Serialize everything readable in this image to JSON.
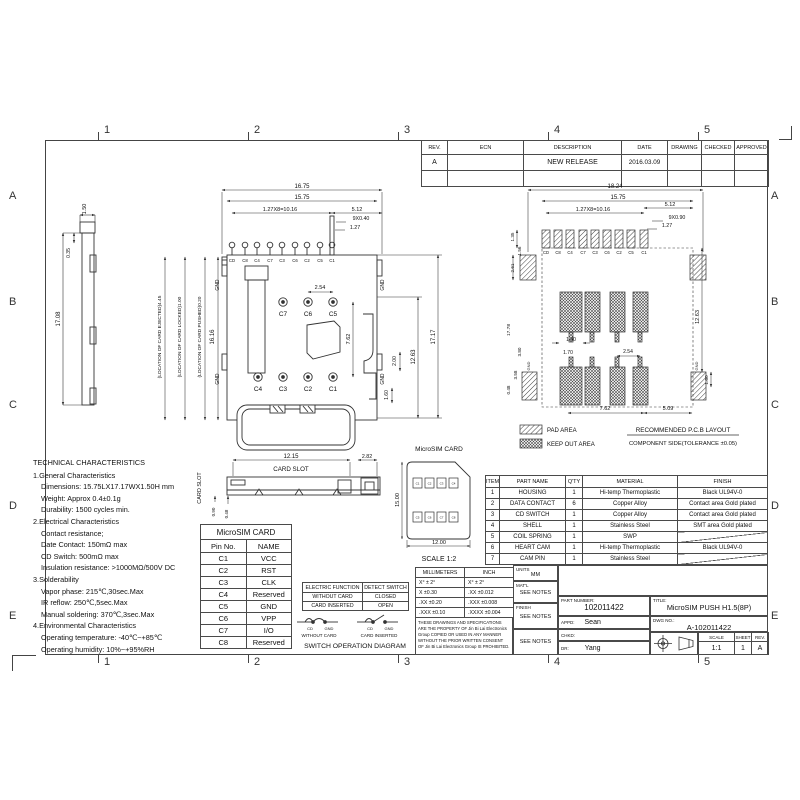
{
  "frame": {
    "cols": [
      "1",
      "2",
      "3",
      "4",
      "5"
    ],
    "rows": [
      "A",
      "B",
      "C",
      "D",
      "E"
    ]
  },
  "rev": {
    "headers": [
      "REV.",
      "ECN",
      "DESCRIPTION",
      "DATE",
      "DRAWING",
      "CHECKED",
      "APPROVED"
    ],
    "row": {
      "rev": "A",
      "ecn": "",
      "description": "NEW RELEASE",
      "date": "2016.03.09",
      "drawing": "",
      "checked": "",
      "approved": ""
    }
  },
  "side": {
    "d_w": "1.50",
    "d_step": "0.35",
    "d_h": "17.08"
  },
  "top": {
    "d1": "16.75",
    "d2": "15.75",
    "d3": "1.27X8=10.16",
    "d4": "5.12",
    "d5": "9X0.40",
    "d6": "1.27",
    "pins": [
      "CD",
      "C8",
      "C4",
      "C7",
      "C3",
      "C6",
      "C2",
      "C5",
      "C1"
    ],
    "gnd": "GND",
    "uc": [
      "C7",
      "C6",
      "C5"
    ],
    "lc": [
      "C4",
      "C3",
      "C2",
      "C1"
    ],
    "d7": "2.54",
    "d8": "7.62",
    "d9": "12.63",
    "d10": "17.17",
    "d11": "16.16",
    "d12": "2.00",
    "d13": "1.60",
    "loc": [
      "(LOCATION OF CARD EJECTED)4.45",
      "(LOCATION OF CARD LOCKED)1.00",
      "(LOCATION OF CARD PUSHED)0.20"
    ]
  },
  "pcb": {
    "d1": "18.24",
    "d2": "15.75",
    "d3": "1.27X8=10.16",
    "d4": "5.12",
    "d5": "9X0.90",
    "d6": "1.27",
    "pins": [
      "CD",
      "C8",
      "C4",
      "C7",
      "C3",
      "C6",
      "C2",
      "C5",
      "C1"
    ],
    "d135": "1.35",
    "d156": "1.56",
    "d261": "2.61",
    "d1778": "17.78",
    "d380": "3.80",
    "d358": "3.58",
    "d048": "0.48",
    "d140": "1.40",
    "d170": "1.70",
    "d254": "2.54",
    "d762": "7.62",
    "d509": "5.09",
    "d1263": "12.63",
    "d160": "1.60",
    "gnd": "GND",
    "legend_pad": "PAD AREA",
    "legend_keepout": "KEEP OUT AREA",
    "note1": "RECOMMENDED P.C.B LAYOUT",
    "note2": "COMPONENT SIDE(TOLERANCE ±0.05)"
  },
  "front": {
    "d_w": "12.15",
    "d_r": "2.82",
    "slot": "CARD SLOT",
    "d1": "0.90",
    "d2": "0.48"
  },
  "card": {
    "title": "MicroSIM CARD",
    "h": "15.00",
    "w": "12.00",
    "scale": "SCALE 1:2",
    "pads": [
      "C1",
      "C2",
      "C3",
      "C4",
      "C5",
      "C6",
      "C7",
      "C8"
    ]
  },
  "tech": {
    "title": "TECHNICAL CHARACTERISTICS",
    "lines": [
      "1.General Characteristics",
      "Dimensions: 15.75LX17.17WX1.50H mm",
      "Weight: Approx 0.4±0.1g",
      "Durability: 1500 cycles min.",
      "2.Electrical Characteristics",
      "Contact resistance;",
      "Date Contact: 150mΩ max",
      "CD Switch: 500mΩ max",
      "Insulation resistance: >1000MΩ/500V DC",
      "3.Solderability",
      "Vapor phase: 215℃,30sec.Max",
      "IR reflow: 250℃,5sec.Max",
      "Manual soldering: 370℃,3sec.Max",
      "4.Environmental Characteristics",
      "Operating temperature: -40℃~+85℃",
      "Operating humidity: 10%~+95%RH"
    ]
  },
  "pin": {
    "title": "MicroSIM CARD",
    "h0": "Pin No.",
    "h1": "NAME",
    "rows": [
      [
        "C1",
        "VCC"
      ],
      [
        "C2",
        "RST"
      ],
      [
        "C3",
        "CLK"
      ],
      [
        "C4",
        "Reserved"
      ],
      [
        "C5",
        "GND"
      ],
      [
        "C6",
        "VPP"
      ],
      [
        "C7",
        "I/O"
      ],
      [
        "C8",
        "Reserved"
      ]
    ]
  },
  "sw": {
    "t00": "ELECTRIC FUNCTION",
    "t01": "DETECT SWITCH",
    "t10": "WITHOUT CARD",
    "t11": "CLOSED",
    "t20": "CARD INSERTED",
    "t21": "OPEN",
    "cd": "CD",
    "gnd": "GND",
    "cap1": "WITHOUT CARD",
    "cap2": "CARD INSERTED",
    "title": "SWITCH OPERATION DIAGRAM"
  },
  "tol": {
    "h0": "MILLIMETERS",
    "h1": "INCH",
    "rows": [
      [
        "X°  ± 2°",
        "X°  ± 2°"
      ],
      [
        "X  ±0.30",
        ".XX  ±0.012"
      ],
      [
        ".XX ±0.20",
        ".XXX ±0.008"
      ],
      [
        ".XXX ±0.10",
        ".XXXX ±0.004"
      ]
    ]
  },
  "note": "THESE DRAWINGS AND SPECIFICATIONS ARE THE PROPERTY OF Jin Bi Lai Electronics Group COPIED OR USED IN ANY MANNER WITHOUT THE PRIOR WRITTEN CONSENT OF Jin Bi Lai Electronics Group IS PROHIBITED.",
  "parts": {
    "headers": [
      "ITEM",
      "PART NAME",
      "Q'TY",
      "MATERIAL",
      "FINISH"
    ],
    "rows": [
      [
        "1",
        "HOUSING",
        "1",
        "Hi-temp Thermoplastic",
        "Black UL94V-0"
      ],
      [
        "2",
        "DATA CONTACT",
        "6",
        "Copper Alloy",
        "Contact area Gold plated"
      ],
      [
        "3",
        "CD SWITCH",
        "1",
        "Copper Alloy",
        "Contact area Gold plated"
      ],
      [
        "4",
        "SHELL",
        "1",
        "Stainless Steel",
        "SMT area Gold plated"
      ],
      [
        "5",
        "COIL SPRING",
        "1",
        "SWP",
        ""
      ],
      [
        "6",
        "HEART CAM",
        "1",
        "Hi-temp Thermoplastic",
        "Black UL94V-0"
      ],
      [
        "7",
        "CAM PIN",
        "1",
        "Stainless Steel",
        ""
      ]
    ]
  },
  "tb": {
    "units_label": "UNITS",
    "units": "MM",
    "matl_label": "MAT'L",
    "matl": "SEE NOTES",
    "finish_label": "FINISH",
    "finish": "SEE NOTES",
    "notes": "SEE NOTES",
    "pn_label": "PART NUMBER:",
    "pn": "102011422",
    "title_label": "TITLE:",
    "title": "MicroSIM PUSH H1.5(8P)",
    "appd_label": "APPD:",
    "appd": "Sean",
    "chkd_label": "CHKD:",
    "chkd": "",
    "dr_label": "DR:",
    "dr": "Yang",
    "dwg_label": "DWG NO.:",
    "dwg": "A-102011422",
    "scale_label": "SCALE",
    "scale": "1:1",
    "sheet_label": "SHEET",
    "sheet": "1",
    "rev_label": "REV.",
    "rev": "A"
  }
}
